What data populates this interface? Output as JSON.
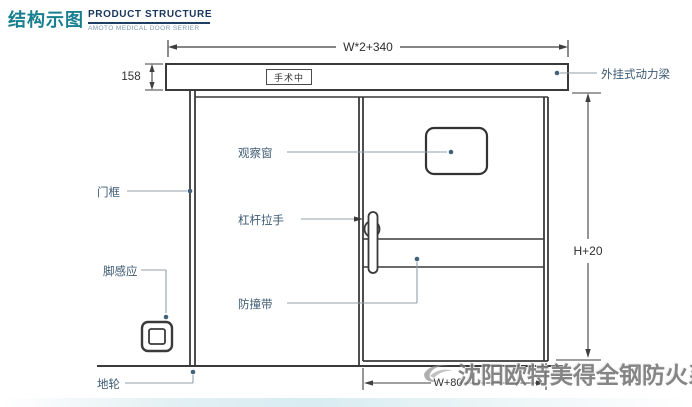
{
  "header": {
    "title_cn": "结构示图",
    "title_en": "PRODUCT STRUCTURE",
    "subtitle_en": "AMOTO MEDICAL DOOR SERIER"
  },
  "diagram": {
    "door_sign": "手术中",
    "dims": {
      "top_width": "W*2+340",
      "beam_height": "158",
      "door_height": "H+20",
      "bottom_width": "W+80"
    },
    "labels": {
      "power_beam": "外挂式动力梁",
      "door_frame": "门框",
      "observation_window": "观察窗",
      "lever_handle": "杠杆拉手",
      "foot_sensor": "脚感应",
      "anti_collision_strip": "防撞带",
      "ground_wheel": "地轮"
    },
    "colors": {
      "title_teal": "#177f8e",
      "title_navy": "#16365c",
      "label_blue": "#3d5a73",
      "line_dark": "#3a3a3a",
      "leader_gray": "#90a0ac",
      "dot_blue": "#44617a",
      "watermark_gray": "#757575"
    }
  },
  "watermark": {
    "text": "沈阳欧特美得全钢防火系统"
  }
}
